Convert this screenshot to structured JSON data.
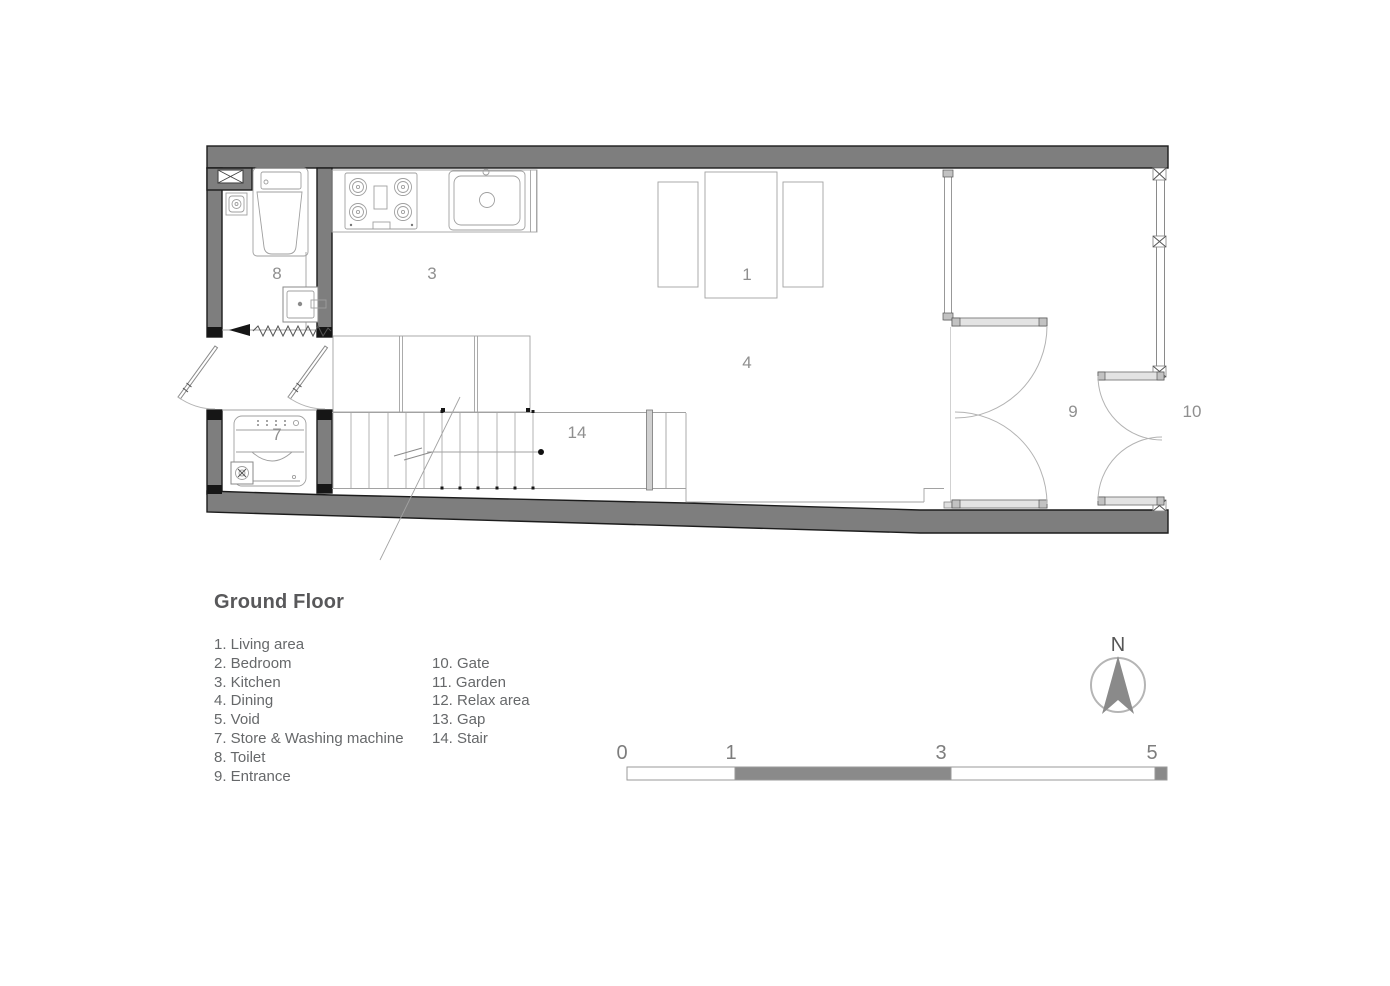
{
  "plan": {
    "room_labels": [
      {
        "name": "toilet",
        "num": "8"
      },
      {
        "name": "kitchen",
        "num": "3"
      },
      {
        "name": "living-area",
        "num": "1"
      },
      {
        "name": "dining",
        "num": "4"
      },
      {
        "name": "stair",
        "num": "14"
      },
      {
        "name": "store-washing-machine",
        "num": "7"
      },
      {
        "name": "entrance",
        "num": "9"
      },
      {
        "name": "gate",
        "num": "10"
      }
    ]
  },
  "legend": {
    "title": "Ground Floor",
    "column1": [
      "1. Living area",
      "2. Bedroom",
      "3. Kitchen",
      "4. Dining",
      "5. Void",
      "7. Store & Washing machine",
      "8. Toilet",
      "9. Entrance"
    ],
    "column2": [
      "10. Gate",
      "11. Garden",
      "12. Relax area",
      "13. Gap",
      "14. Stair"
    ]
  },
  "north_arrow": {
    "label": "N"
  },
  "scale_bar": {
    "labels": [
      "0",
      "1",
      "3",
      "5"
    ]
  },
  "colors": {
    "wall_fill": "#7e7e7e",
    "wall_outline": "#1c1c1c",
    "fixture_line": "#9a9a9a",
    "room_label_text": "#8f8f8f",
    "legend_text": "#66686a",
    "scale_dark_segment": "#8a8a8a",
    "north_arrow_fill": "#8a8a8a"
  }
}
